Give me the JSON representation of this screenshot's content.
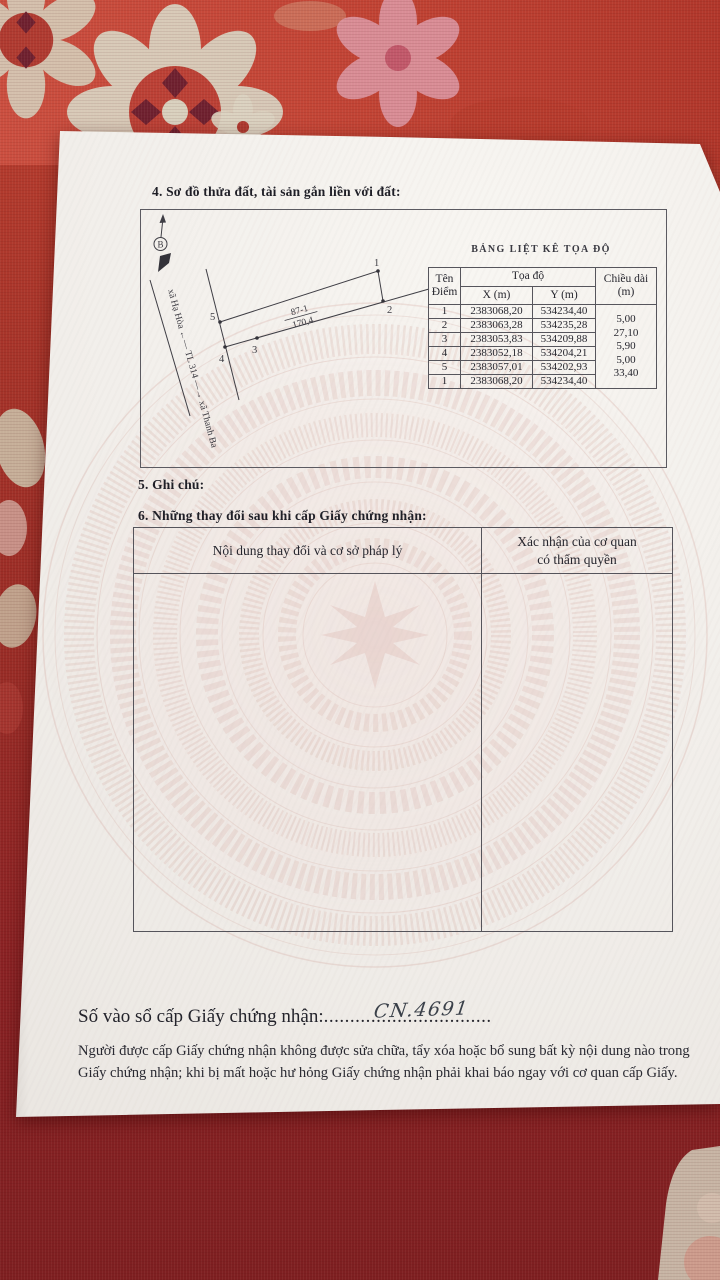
{
  "page": {
    "section4_title": "4. Sơ đồ thửa đất, tài sản gắn liền với đất:",
    "section5_title": "5. Ghi chú:",
    "section6_title": "6. Những thay đổi sau khi cấp Giấy chứng nhận:",
    "registry_label": "Số vào sổ cấp Giấy chứng nhận:",
    "registry_dots": "................................",
    "registry_number_handwritten": "CN.4691",
    "footer_line1": "Người được cấp Giấy chứng nhận không được sửa chữa, tẩy xóa hoặc bổ sung bất kỳ nội dung nào trong",
    "footer_line2": "Giấy chứng nhận; khi bị mất hoặc hư hỏng Giấy chứng nhận phải khai báo ngay với cơ quan cấp Giấy."
  },
  "diagram": {
    "north_label": "B",
    "road_label": "xã Hạ Hòa ←— TL 314 —→ xã Thanh Ba",
    "parcel_number": "87-1",
    "parcel_area": "170,4",
    "p1": "1",
    "p2": "2",
    "p3": "3",
    "p4": "4",
    "p5": "5"
  },
  "coord_table": {
    "title": "BẢNG LIỆT KÊ TỌA ĐỘ",
    "col_point_l1": "Tên",
    "col_point_l2": "Điểm",
    "col_coords": "Tọa độ",
    "col_x": "X (m)",
    "col_y": "Y (m)",
    "col_length_l1": "Chiều dài",
    "col_length_l2": "(m)",
    "rows": [
      {
        "point": "1",
        "x": "2383068,20",
        "y": "534234,40",
        "len": ""
      },
      {
        "point": "2",
        "x": "2383063,28",
        "y": "534235,28",
        "len": "5,00"
      },
      {
        "point": "3",
        "x": "2383053,83",
        "y": "534209,88",
        "len": "27,10"
      },
      {
        "point": "4",
        "x": "2383052,18",
        "y": "534204,21",
        "len": "5,90"
      },
      {
        "point": "5",
        "x": "2383057,01",
        "y": "534202,93",
        "len": "5,00"
      },
      {
        "point": "1",
        "x": "2383068,20",
        "y": "534234,40",
        "len": "33,40"
      }
    ]
  },
  "changes_table": {
    "col1": "Nội dung thay đổi và cơ sở pháp lý",
    "col2_l1": "Xác nhận của cơ quan",
    "col2_l2": "có thẩm quyền"
  },
  "colors": {
    "fabric_red": "#b23a2d",
    "fabric_dark": "#7e1f22",
    "paper": "#f2efeb",
    "ink": "#26262e",
    "watermark_pink": "#d8aba3"
  }
}
